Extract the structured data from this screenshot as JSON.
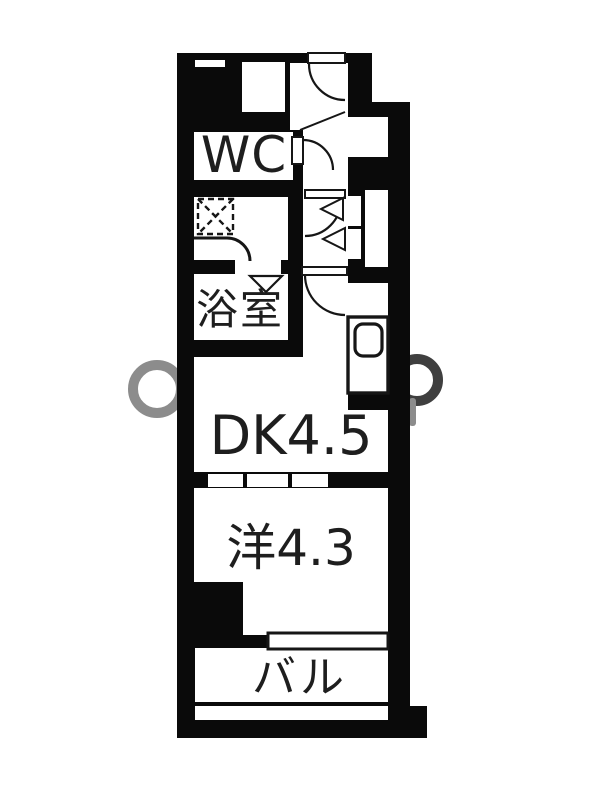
{
  "image_type": "real-estate-floor-plan",
  "palette": {
    "bg": "#ffffff",
    "wall": "#0a0a0a",
    "line": "#161616",
    "text": "#1e1e1e",
    "watermark_light": "#8c8c8c",
    "watermark_dark": "#3f3f3f"
  },
  "rooms": {
    "wc": {
      "label": "WC"
    },
    "bath": {
      "label": "浴室"
    },
    "dining_kitchen": {
      "label": "DK4.5"
    },
    "western_room": {
      "label": "洋4.3"
    },
    "balcony": {
      "label": "バル"
    }
  },
  "fixtures": [
    "entrance-door-swing",
    "wc-door-swing",
    "washroom-door-swing",
    "storage-double-doors",
    "bathroom-door-triangle",
    "dk-door-swing",
    "gas-stove-dashed-square",
    "kitchen-counter-rounded",
    "washing-machine-pan",
    "sliding-door-3-panel",
    "sliding-window",
    "vent-slit"
  ]
}
